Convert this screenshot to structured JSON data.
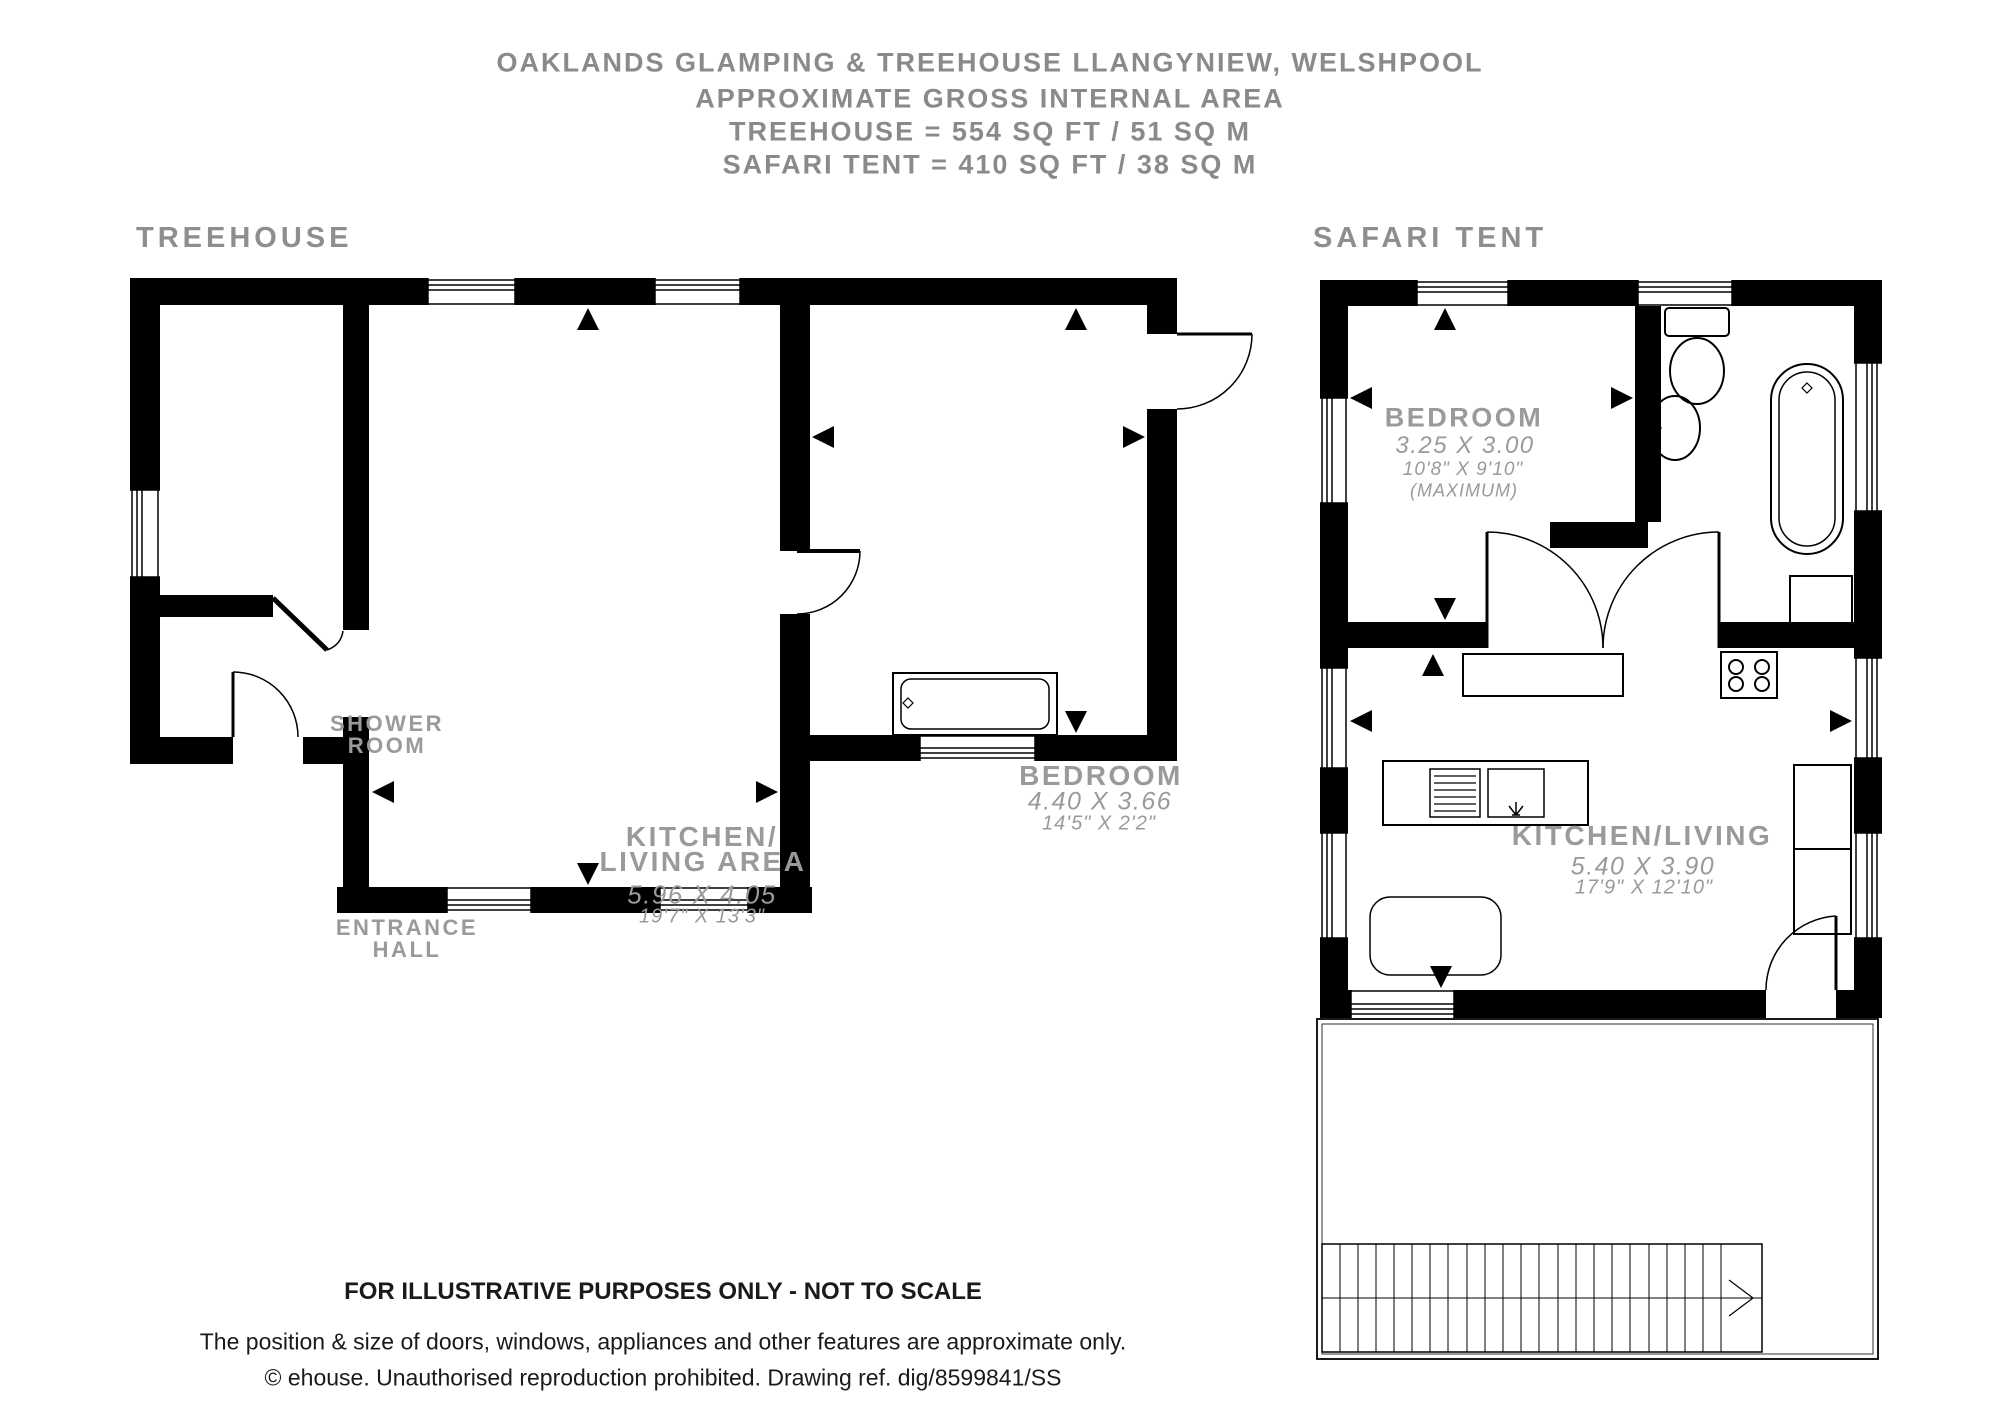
{
  "title": {
    "line1": "OAKLANDS GLAMPING & TREEHOUSE LLANGYNIEW, WELSHPOOL",
    "line2": "APPROXIMATE GROSS INTERNAL AREA",
    "line3": "TREEHOUSE = 554 SQ FT / 51 SQ M",
    "line4": "SAFARI TENT = 410 SQ FT / 38 SQ M"
  },
  "plans": {
    "treehouse": {
      "heading": "TREEHOUSE",
      "rooms": {
        "shower_room": {
          "line1": "SHOWER",
          "line2": "ROOM"
        },
        "entrance_hall": {
          "line1": "ENTRANCE",
          "line2": "HALL"
        },
        "kitchen_living": {
          "line1": "KITCHEN/",
          "line2": "LIVING AREA",
          "dims_m": "5.96 X 4.05",
          "dims_ft": "19'7\" X 13'3\""
        },
        "bedroom": {
          "name": "BEDROOM",
          "dims_m": "4.40 X 3.66",
          "dims_ft": "14'5\" X 2'2\""
        }
      }
    },
    "safari_tent": {
      "heading": "SAFARI TENT",
      "rooms": {
        "bedroom": {
          "name": "BEDROOM",
          "dims_m": "3.25 X 3.00",
          "dims_ft": "10'8\" X 9'10\"",
          "note": "(MAXIMUM)"
        },
        "kitchen_living": {
          "name": "KITCHEN/LIVING",
          "dims_m": "5.40 X 3.90",
          "dims_ft": "17'9\" X 12'10\""
        }
      }
    }
  },
  "footer": {
    "line1": "FOR ILLUSTRATIVE PURPOSES ONLY - NOT TO SCALE",
    "line2": "The position & size of doors, windows, appliances and other features are approximate only.",
    "line3": "© ehouse. Unauthorised reproduction prohibited. Drawing ref. dig/8599841/SS"
  },
  "colors": {
    "wall": "#000000",
    "label_gray": "#9a9a9a",
    "heading_gray": "#8e8e8e",
    "footer_text": "#1a1a1a"
  }
}
